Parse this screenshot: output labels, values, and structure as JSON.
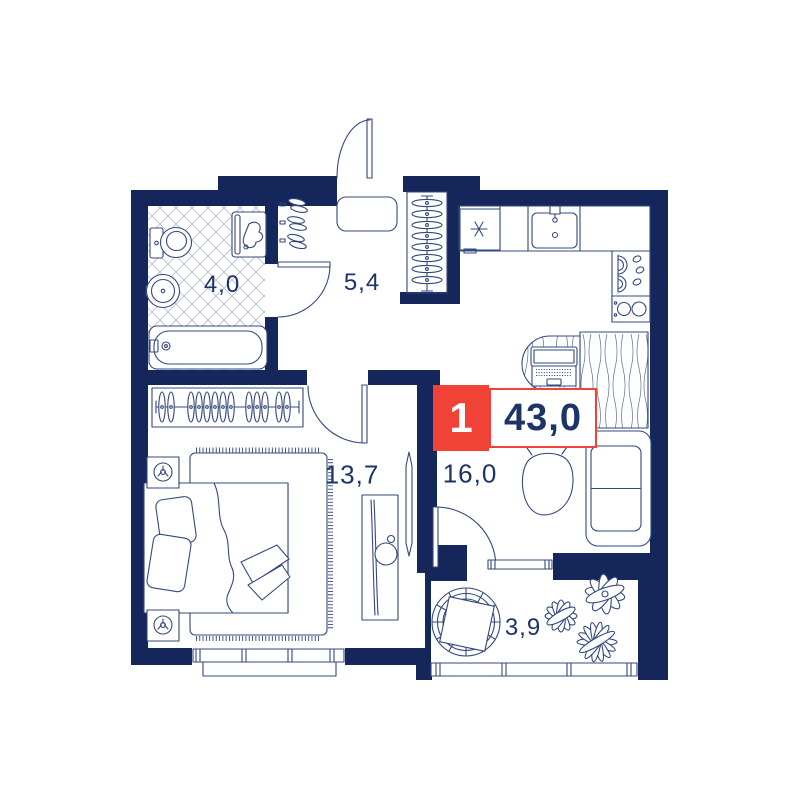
{
  "plan": {
    "title": "apartment-floor-plan",
    "badge": {
      "rooms_count": "1",
      "total_area": "43,0"
    },
    "rooms": {
      "bathroom": {
        "area": "4,0"
      },
      "hallway": {
        "area": "5,4"
      },
      "bedroom": {
        "area": "13,7"
      },
      "kitchen_living": {
        "area": "16,0"
      },
      "balcony": {
        "area": "3,9"
      }
    },
    "colors": {
      "wall": "#15265B",
      "furniture_line": "#33487F",
      "accent_red": "#F04237",
      "label_text": "#1C3468",
      "tile_line": "#B3BCD6"
    }
  }
}
